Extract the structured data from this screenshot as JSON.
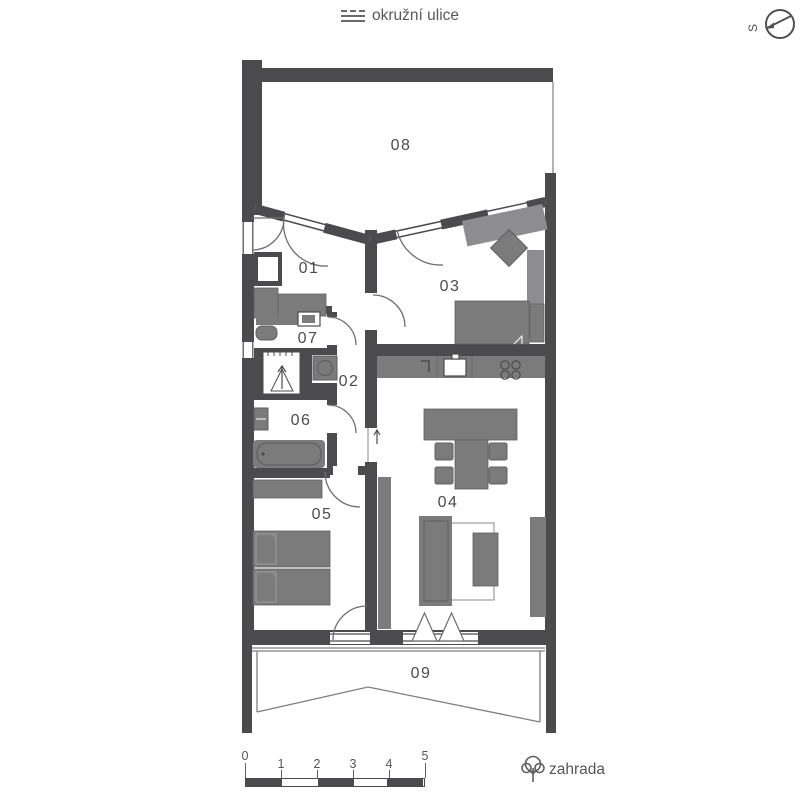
{
  "header": {
    "street_label": "okružní ulice"
  },
  "compass": {
    "north_letter": "S"
  },
  "plan": {
    "rooms": [
      {
        "number": "01"
      },
      {
        "number": "02"
      },
      {
        "number": "03"
      },
      {
        "number": "04"
      },
      {
        "number": "05"
      },
      {
        "number": "06"
      },
      {
        "number": "07"
      },
      {
        "number": "08"
      },
      {
        "number": "09"
      }
    ]
  },
  "scale_bar": {
    "ticks": [
      "0",
      "1",
      "2",
      "3",
      "4",
      "5"
    ]
  },
  "garden": {
    "label": "zahrada"
  },
  "colors": {
    "wall": "#4b4b4d",
    "furniture": "#7b7b7c",
    "furniture_light": "#8d8d8f",
    "outline": "#5f5f61",
    "thin_line": "#7f7f81",
    "text": "#515155"
  }
}
